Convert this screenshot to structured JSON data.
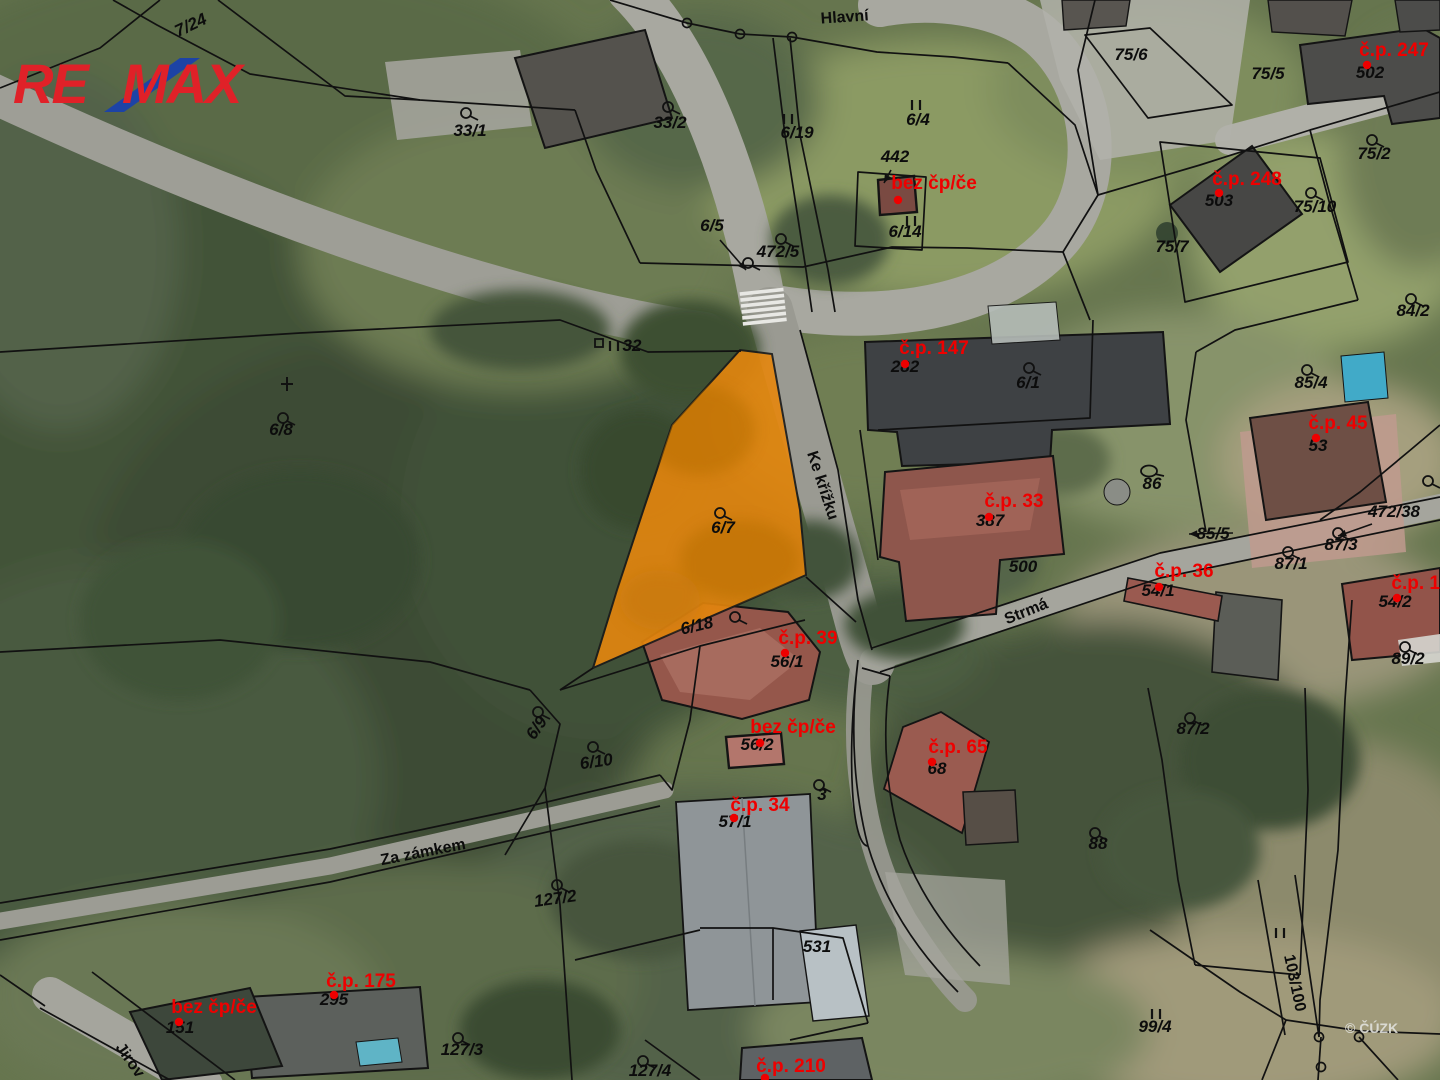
{
  "logo": {
    "re": "RE",
    "max": "MAX",
    "red": "#e02128",
    "blue": "#1d43a6"
  },
  "watermark": "© ČÚZK",
  "map": {
    "highlight": {
      "parcel": "6/7",
      "color": "#e6870e"
    },
    "streets": [
      {
        "label": "Hlavní",
        "x": 845,
        "y": 22,
        "rot": -4
      },
      {
        "label": "Ke křížku",
        "x": 818,
        "y": 487,
        "rot": 72
      },
      {
        "label": "Strmá",
        "x": 1028,
        "y": 616,
        "rot": -22
      },
      {
        "label": "Za zámkem",
        "x": 424,
        "y": 857,
        "rot": -11
      },
      {
        "label": "Jirov",
        "x": 126,
        "y": 1063,
        "rot": 55
      },
      {
        "label": "103/100",
        "x": 1290,
        "y": 984,
        "rot": 78
      }
    ],
    "parcel_labels": [
      {
        "label": "7/24",
        "x": 193,
        "y": 30,
        "rot": -25
      },
      {
        "label": "33/1",
        "x": 470,
        "y": 136,
        "sym": "circle",
        "sx": 466,
        "sy": 113
      },
      {
        "label": "33/2",
        "x": 670,
        "y": 128,
        "sym": "circle",
        "sx": 668,
        "sy": 107
      },
      {
        "label": "6/19",
        "x": 797,
        "y": 138,
        "sym": "II",
        "sx": 788,
        "sy": 119
      },
      {
        "label": "6/4",
        "x": 918,
        "y": 125,
        "sym": "II",
        "sx": 916,
        "sy": 105
      },
      {
        "label": "442",
        "x": 895,
        "y": 162,
        "arrow": [
          891,
          170,
          884,
          183
        ]
      },
      {
        "label": "6/5",
        "x": 712,
        "y": 231,
        "arrow": [
          720,
          240,
          746,
          270
        ]
      },
      {
        "label": "472/5",
        "x": 778,
        "y": 257,
        "sym": "circle",
        "sx": 781,
        "sy": 239
      },
      {
        "label": "6/14",
        "x": 905,
        "y": 237,
        "sym": "II",
        "sx": 911,
        "sy": 221
      },
      {
        "label": "75/6",
        "x": 1131,
        "y": 60
      },
      {
        "label": "75/5",
        "x": 1268,
        "y": 79
      },
      {
        "label": "502",
        "x": 1370,
        "y": 78
      },
      {
        "label": "75/2",
        "x": 1374,
        "y": 159,
        "sym": "circle",
        "sx": 1372,
        "sy": 140
      },
      {
        "label": "503",
        "x": 1219,
        "y": 206
      },
      {
        "label": "75/10",
        "x": 1315,
        "y": 212,
        "sym": "circle",
        "sx": 1311,
        "sy": 193
      },
      {
        "label": "75/7",
        "x": 1172,
        "y": 252
      },
      {
        "label": "84/2",
        "x": 1413,
        "y": 316,
        "sym": "circle",
        "sx": 1411,
        "sy": 299
      },
      {
        "label": "32",
        "x": 632,
        "y": 351,
        "size": 12
      },
      {
        "label": "6/8",
        "x": 281,
        "y": 435,
        "sym": "circle",
        "sx": 283,
        "sy": 418
      },
      {
        "label": "282",
        "x": 905,
        "y": 372
      },
      {
        "label": "6/1",
        "x": 1028,
        "y": 388,
        "sym": "circle",
        "sx": 1029,
        "sy": 368
      },
      {
        "label": "85/4",
        "x": 1311,
        "y": 388,
        "sym": "circle",
        "sx": 1307,
        "sy": 370
      },
      {
        "label": "53",
        "x": 1318,
        "y": 451
      },
      {
        "label": "86",
        "x": 1152,
        "y": 489,
        "sym": "oval",
        "sx": 1149,
        "sy": 471
      },
      {
        "label": "472/38",
        "x": 1394,
        "y": 517,
        "arrow": [
          1372,
          524,
          1338,
          536
        ],
        "sym": "circle",
        "sx": 1428,
        "sy": 481
      },
      {
        "label": "6/7",
        "x": 723,
        "y": 533,
        "sym": "circle",
        "sx": 720,
        "sy": 513
      },
      {
        "label": "387",
        "x": 990,
        "y": 526
      },
      {
        "label": "500",
        "x": 1023,
        "y": 572
      },
      {
        "label": "85/5",
        "x": 1213,
        "y": 539,
        "arrow": [
          1233,
          533,
          1189,
          534
        ]
      },
      {
        "label": "87/3",
        "x": 1341,
        "y": 550,
        "sym": "circle",
        "sx": 1338,
        "sy": 533
      },
      {
        "label": "87/1",
        "x": 1291,
        "y": 569,
        "sym": "circle",
        "sx": 1288,
        "sy": 552
      },
      {
        "label": "54/1",
        "x": 1158,
        "y": 596
      },
      {
        "label": "54/2",
        "x": 1395,
        "y": 607
      },
      {
        "label": "89/2",
        "x": 1408,
        "y": 664,
        "sym": "circle",
        "sx": 1405,
        "sy": 647
      },
      {
        "label": "6/18",
        "x": 698,
        "y": 631,
        "rot": -13,
        "sym": "circle",
        "sx": 735,
        "sy": 617
      },
      {
        "label": "56/1",
        "x": 787,
        "y": 667
      },
      {
        "label": "6/9",
        "x": 541,
        "y": 731,
        "rot": -55,
        "sym": "circle",
        "sx": 538,
        "sy": 712
      },
      {
        "label": "6/10",
        "x": 597,
        "y": 767,
        "rot": -8,
        "sym": "circle",
        "sx": 593,
        "sy": 747
      },
      {
        "label": "56/2",
        "x": 757,
        "y": 750
      },
      {
        "label": "3",
        "x": 822,
        "y": 800,
        "sym": "circle",
        "sx": 819,
        "sy": 785
      },
      {
        "label": "68",
        "x": 937,
        "y": 774
      },
      {
        "label": "57/1",
        "x": 735,
        "y": 827
      },
      {
        "label": "87/2",
        "x": 1193,
        "y": 734,
        "sym": "circle",
        "sx": 1190,
        "sy": 718
      },
      {
        "label": "88",
        "x": 1098,
        "y": 849,
        "sym": "circle",
        "sx": 1095,
        "sy": 833
      },
      {
        "label": "127/2",
        "x": 556,
        "y": 904,
        "rot": -8,
        "sym": "circle",
        "sx": 557,
        "sy": 885
      },
      {
        "label": "531",
        "x": 817,
        "y": 952
      },
      {
        "label": "99/4",
        "x": 1155,
        "y": 1032,
        "sym": "II",
        "sx": 1156,
        "sy": 1014
      },
      {
        "label": "295",
        "x": 334,
        "y": 1005
      },
      {
        "label": "151",
        "x": 180,
        "y": 1033
      },
      {
        "label": "127/3",
        "x": 462,
        "y": 1055,
        "sym": "circle",
        "sx": 458,
        "sy": 1038
      },
      {
        "label": "127/4",
        "x": 650,
        "y": 1076,
        "sym": "circle",
        "sx": 643,
        "sy": 1061
      }
    ],
    "extra_symbols": [
      {
        "sym": "circle",
        "x": 748,
        "y": 263
      },
      {
        "sym": "square",
        "x": 599,
        "y": 343
      },
      {
        "sym": "II",
        "x": 614,
        "y": 346
      },
      {
        "sym": "cross",
        "x": 287,
        "y": 384
      },
      {
        "sym": "II",
        "x": 1280,
        "y": 933
      }
    ],
    "house_labels": [
      {
        "label": "bez čp/če",
        "x": 934,
        "y": 189,
        "dx": 898,
        "dy": 200
      },
      {
        "label": "č.p. 247",
        "x": 1394,
        "y": 56,
        "dx": 1367,
        "dy": 65
      },
      {
        "label": "č.p. 248",
        "x": 1247,
        "y": 185,
        "dx": 1219,
        "dy": 193
      },
      {
        "label": "č.p. 147",
        "x": 934,
        "y": 354,
        "dx": 905,
        "dy": 364
      },
      {
        "label": "č.p. 45",
        "x": 1338,
        "y": 429,
        "dx": 1316,
        "dy": 438
      },
      {
        "label": "č.p. 33",
        "x": 1014,
        "y": 507,
        "dx": 989,
        "dy": 517
      },
      {
        "label": "č.p. 36",
        "x": 1184,
        "y": 577,
        "dx": 1159,
        "dy": 587
      },
      {
        "label": "č.p. 13",
        "x": 1421,
        "y": 589,
        "dx": 1397,
        "dy": 598
      },
      {
        "label": "č.p. 39",
        "x": 808,
        "y": 644,
        "dx": 785,
        "dy": 653
      },
      {
        "label": "bez čp/če",
        "x": 793,
        "y": 733,
        "dx": 760,
        "dy": 743
      },
      {
        "label": "č.p. 65",
        "x": 958,
        "y": 753,
        "dx": 932,
        "dy": 762
      },
      {
        "label": "č.p. 34",
        "x": 760,
        "y": 811,
        "dx": 734,
        "dy": 818
      },
      {
        "label": "č.p. 175",
        "x": 361,
        "y": 987,
        "dx": 334,
        "dy": 995
      },
      {
        "label": "bez čp/če",
        "x": 214,
        "y": 1013,
        "dx": 179,
        "dy": 1022
      },
      {
        "label": "č.p. 210",
        "x": 791,
        "y": 1072,
        "dx": 765,
        "dy": 1078
      }
    ]
  }
}
